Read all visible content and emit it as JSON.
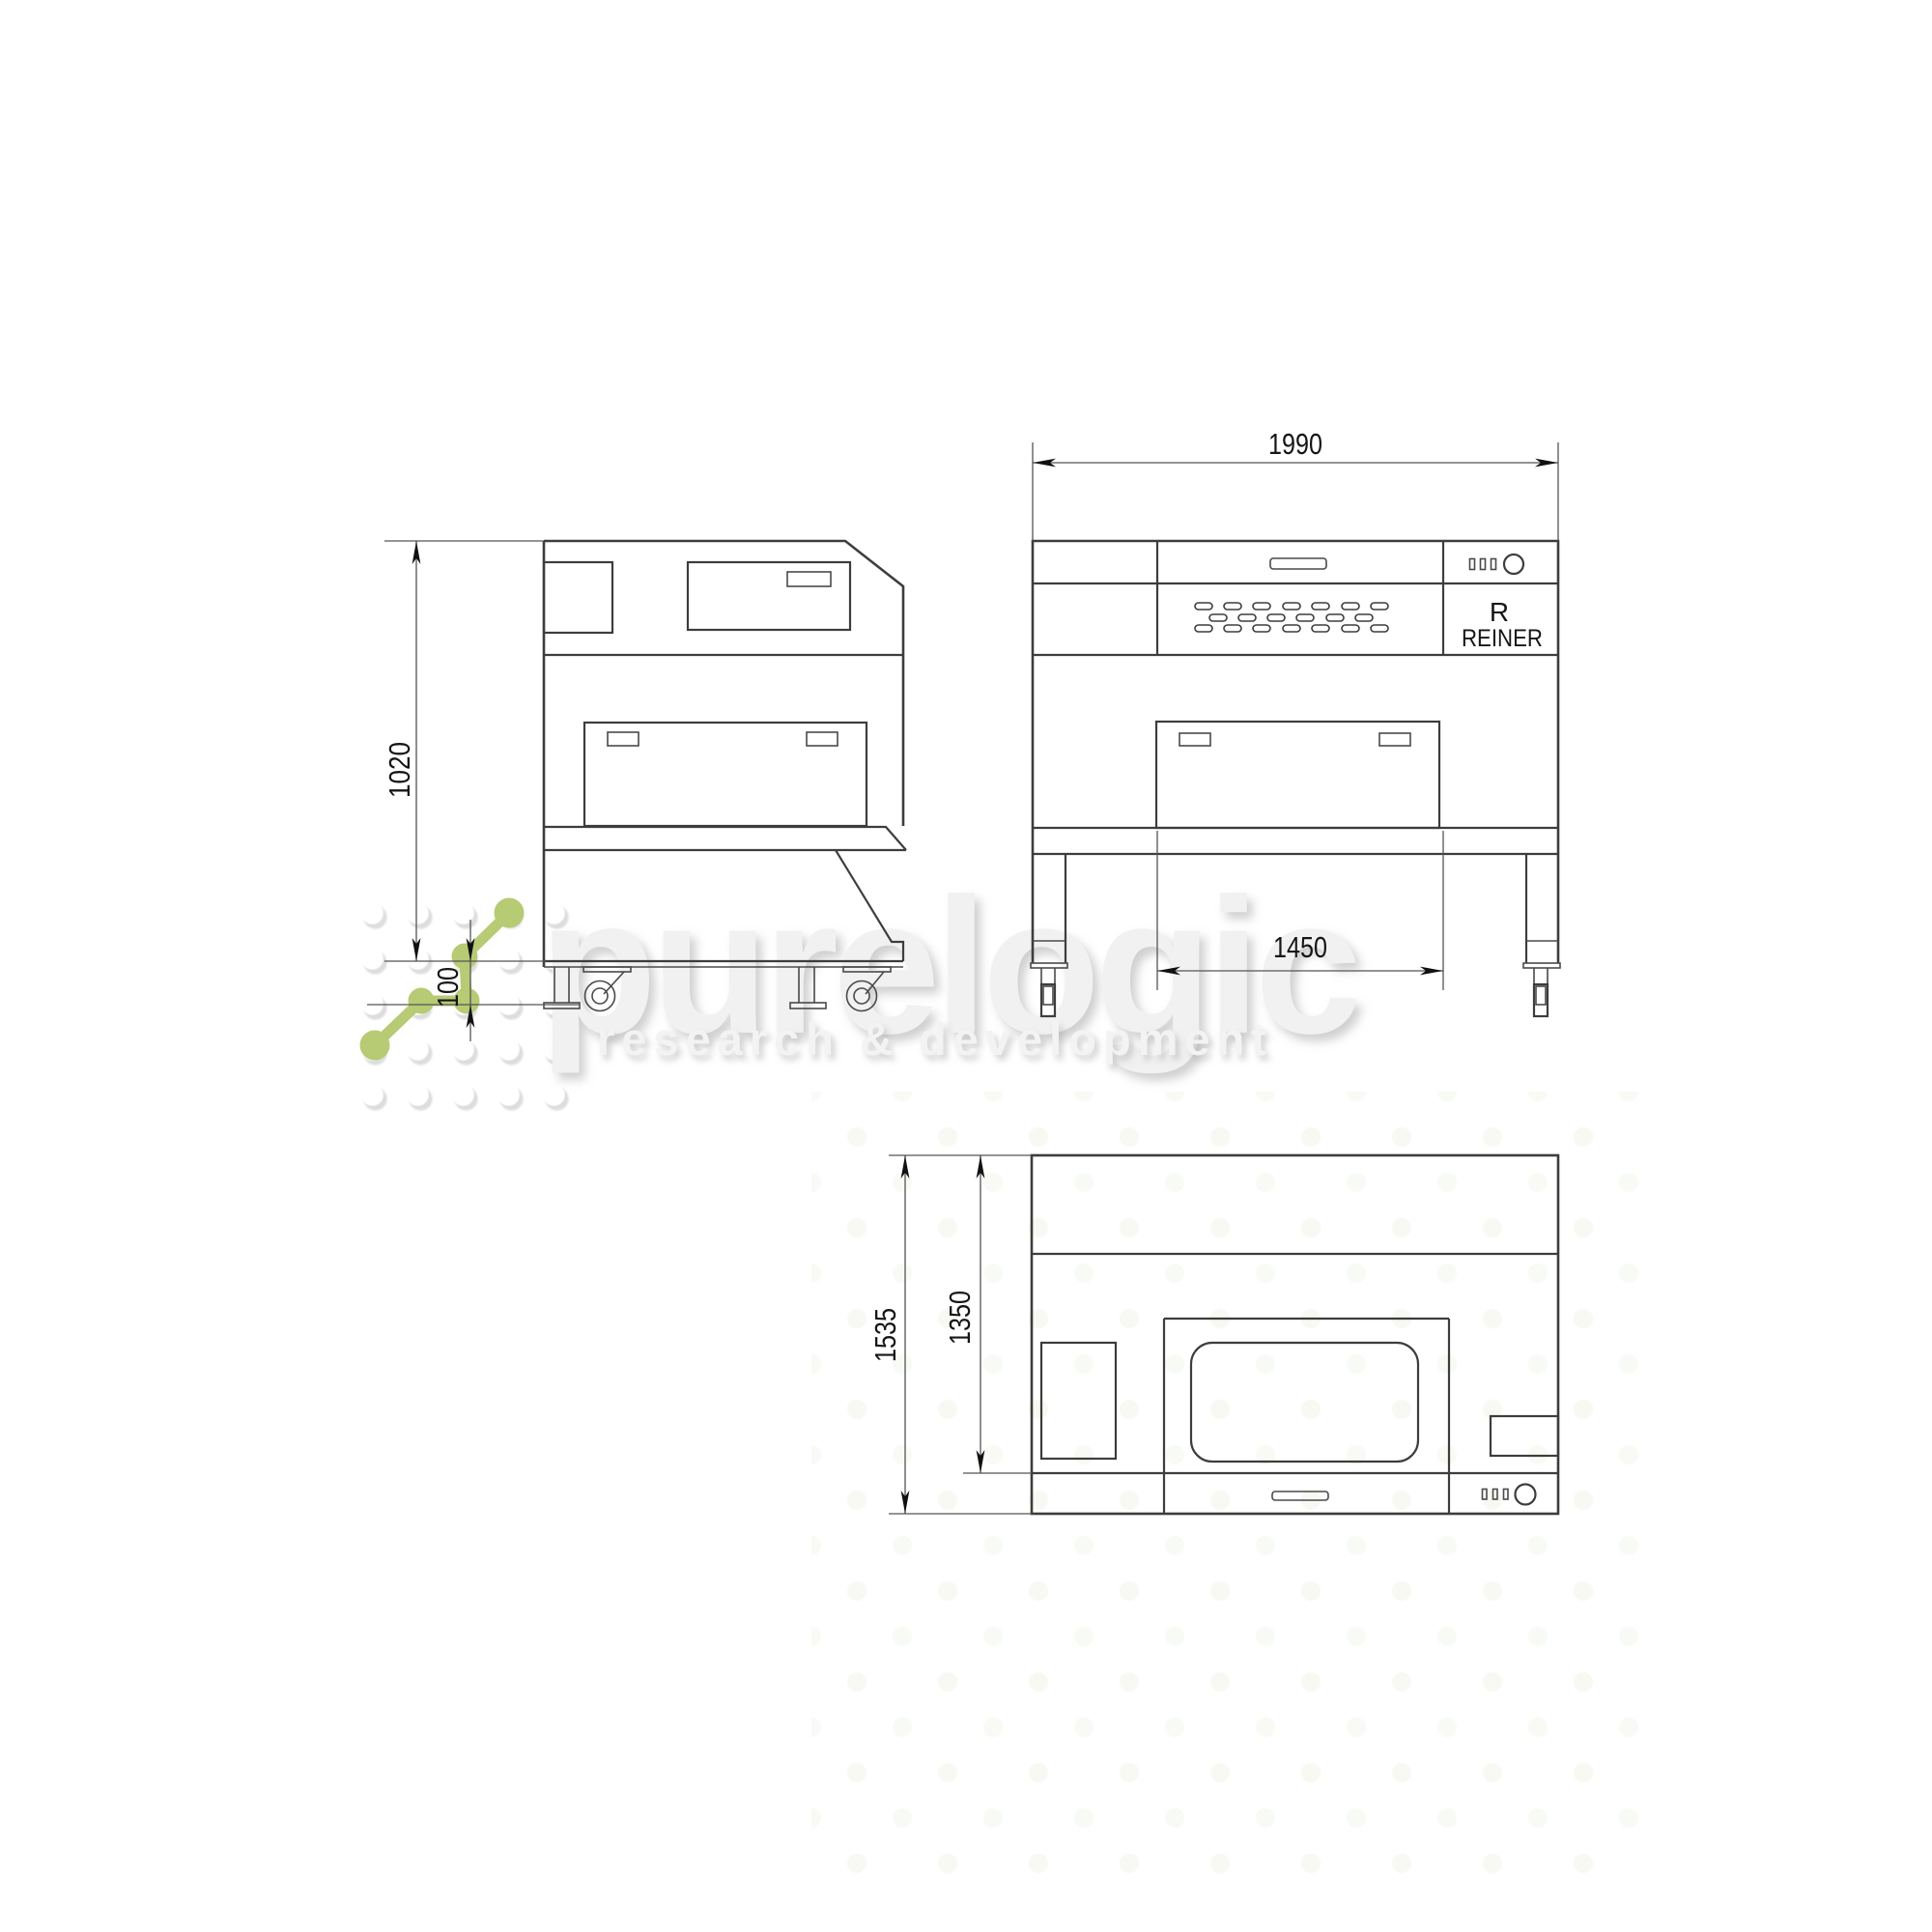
{
  "watermark": {
    "brand": "purelogic",
    "tagline": "research & development",
    "accent_color": "#b7ca74"
  },
  "brand_panel": {
    "letter": "R",
    "name": "REINER"
  },
  "dims": {
    "front_width": "1990",
    "front_inner": "1450",
    "side_height": "1020",
    "side_base": "100",
    "top_total": "1535",
    "top_inner": "1350"
  }
}
